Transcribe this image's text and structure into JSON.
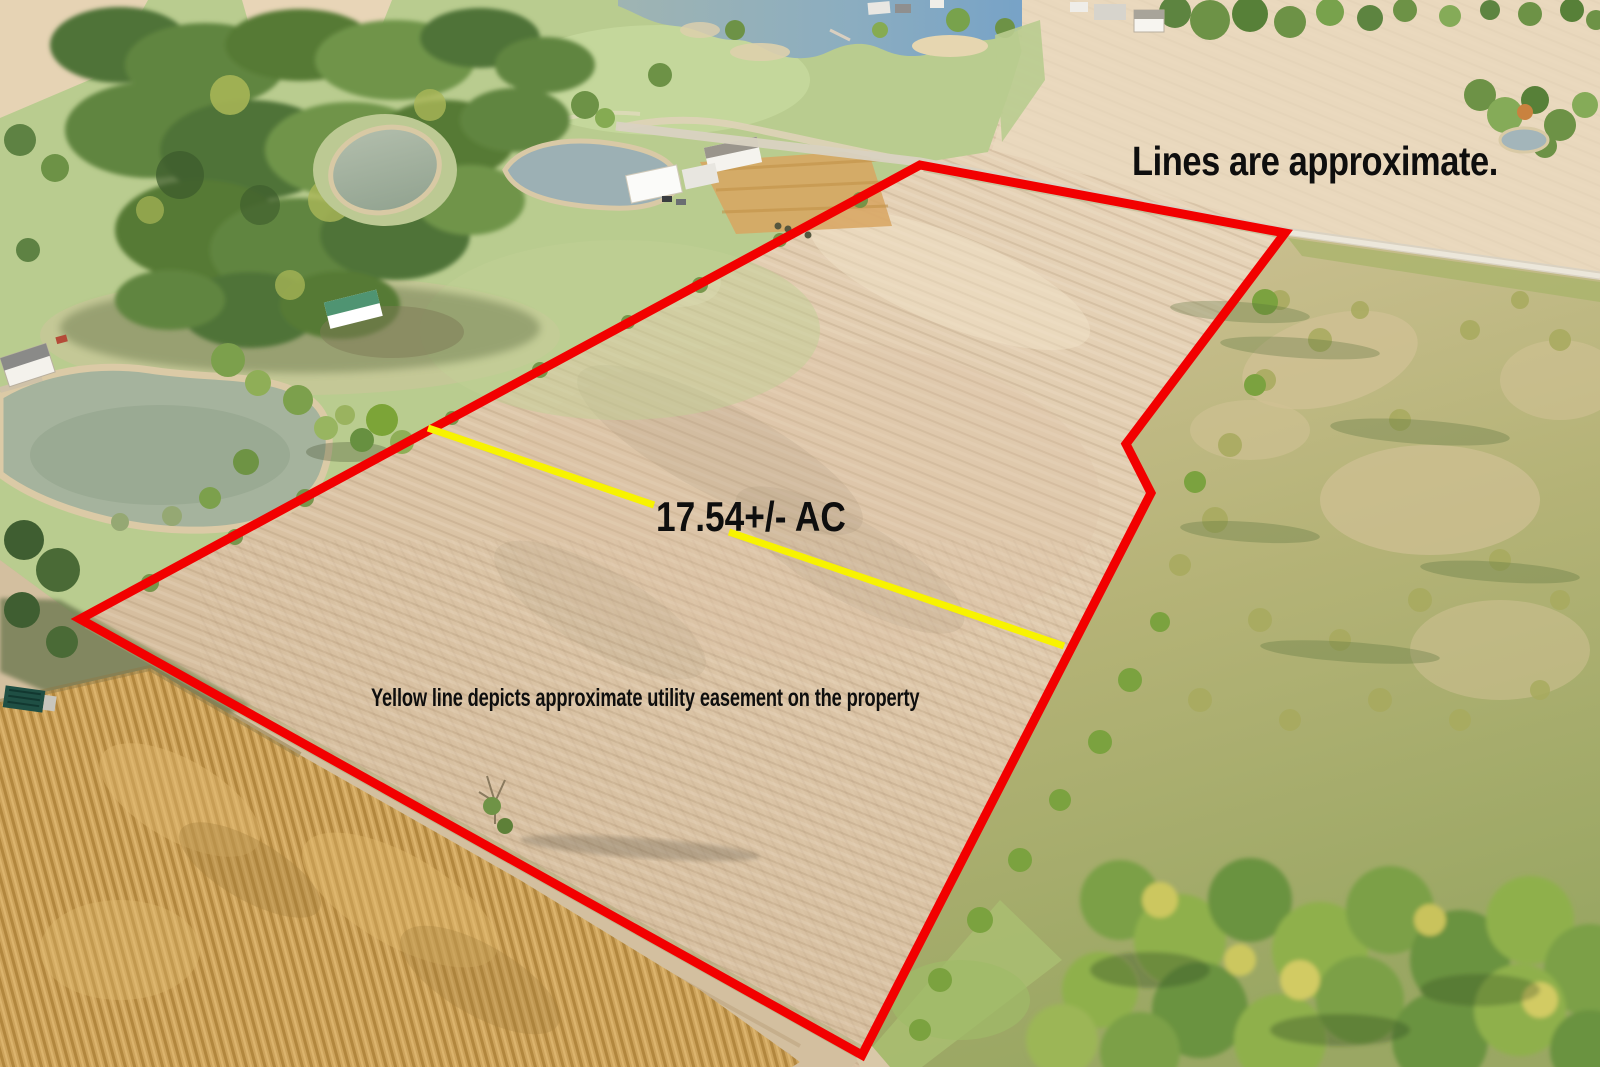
{
  "photo": {
    "kind": "aerial-drone-photo-of-farmland-parcel"
  },
  "annotations": {
    "disclaimer": "Lines are approximate.",
    "acreage": "17.54+/- AC",
    "easement_note": "Yellow line depicts approximate utility easement on the property"
  },
  "colors": {
    "boundary_line": "#f20000",
    "easement_line": "#f8f300",
    "annotation_text": "#0e0e0e"
  }
}
